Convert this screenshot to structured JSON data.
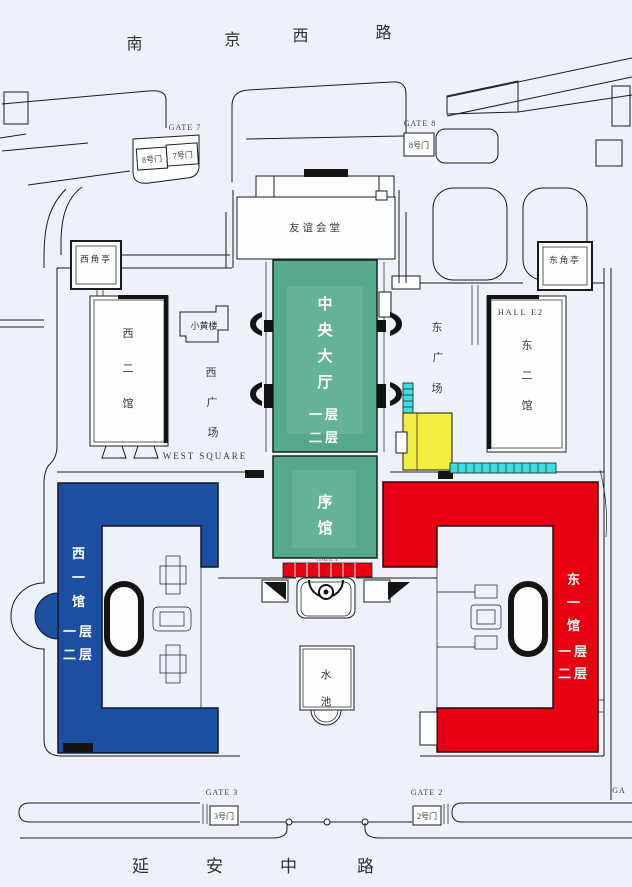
{
  "roads": {
    "north": {
      "name_chars": [
        "南",
        "京",
        "西",
        "路"
      ]
    },
    "south": {
      "name_chars": [
        "延",
        "安",
        "中",
        "路"
      ]
    }
  },
  "gates": {
    "gate7": {
      "label": "GATE 7",
      "doors": [
        "8号门",
        "7号门"
      ]
    },
    "gate8": {
      "label": "GATE 8",
      "door": "8号门"
    },
    "gate3": {
      "label": "GATE 3",
      "door": "3号门"
    },
    "gate2": {
      "label": "GATE 2",
      "door": "2号门"
    },
    "gate_east_partial": {
      "label": "GA"
    },
    "main_gate": {
      "label": "GATE 1"
    }
  },
  "buildings": {
    "friendship_hall": {
      "name": "友谊会堂"
    },
    "central_hall": {
      "name_chars": [
        "中",
        "央",
        "大",
        "厅"
      ],
      "floors": [
        "一层",
        "二层"
      ]
    },
    "preface_hall": {
      "name_chars": [
        "序",
        "馆"
      ]
    },
    "west_hall_1": {
      "name_chars": [
        "西",
        "一",
        "馆"
      ],
      "floors": [
        "一层",
        "二层"
      ]
    },
    "east_hall_1": {
      "name_chars": [
        "东",
        "一",
        "馆"
      ],
      "floors": [
        "一层",
        "二层"
      ]
    },
    "west_hall_2": {
      "name_chars": [
        "西",
        "二",
        "馆"
      ]
    },
    "east_hall_2": {
      "name_chars": [
        "东",
        "二",
        "馆"
      ],
      "label_en": "HALL E2"
    },
    "small_yellow_building": {
      "name": "小黄楼"
    },
    "west_corner_pavilion": {
      "name": "西角亭"
    },
    "east_corner_pavilion": {
      "name": "东角亭"
    },
    "pool": {
      "name_chars": [
        "水",
        "池"
      ]
    }
  },
  "squares": {
    "west": {
      "name_chars": [
        "西",
        "广",
        "场"
      ],
      "label_en": "WEST SQUARE"
    },
    "east": {
      "name_chars": [
        "东",
        "广",
        "场"
      ]
    }
  },
  "colors": {
    "background": "#edf2fa",
    "central_hall_green": "#55a88c",
    "central_hall_green_light": "#66b298",
    "west_hall_blue": "#1c4f9f",
    "east_hall_red": "#e60012",
    "ramp_yellow": "#f1ee3f",
    "corridor_cyan": "#3cdfe0",
    "outline": "#1b1b1b"
  }
}
